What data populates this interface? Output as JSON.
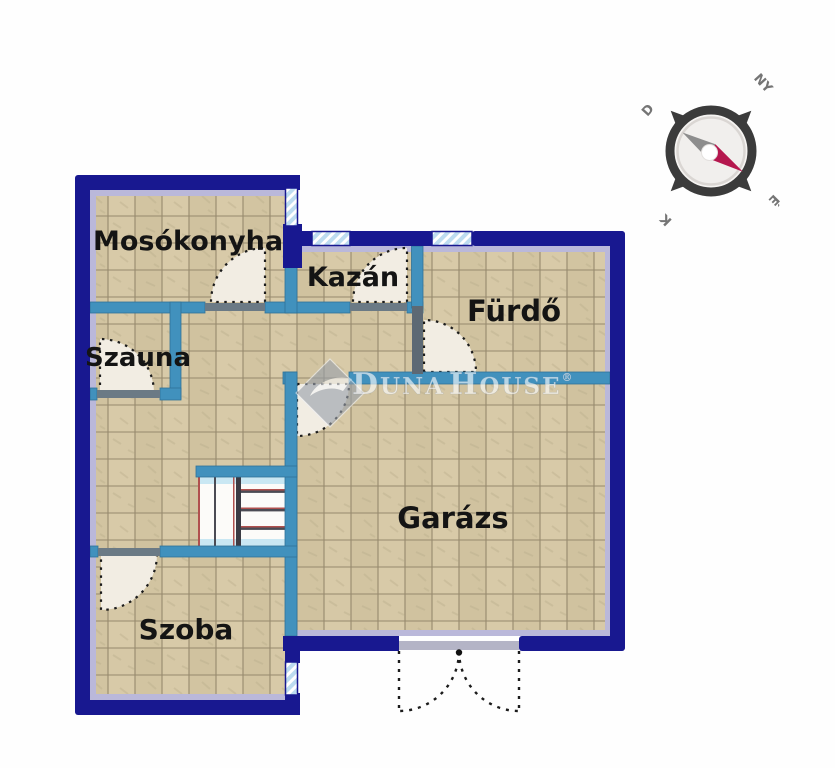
{
  "plan": {
    "rooms": [
      {
        "id": "mosokonyha",
        "label": "Mosókonyha"
      },
      {
        "id": "kazan",
        "label": "Kazán"
      },
      {
        "id": "furdo",
        "label": "Fürdő"
      },
      {
        "id": "szauna",
        "label": "Szauna"
      },
      {
        "id": "garazs",
        "label": "Garázs"
      },
      {
        "id": "szoba",
        "label": "Szoba"
      }
    ]
  },
  "compass": {
    "north": "É",
    "south": "D",
    "east": "K",
    "west": "NY"
  },
  "watermark": {
    "part1": "D",
    "part2": "UNA",
    "part3": "H",
    "part4": "OUSE",
    "registered": "®"
  },
  "colors": {
    "outer_wall_navy": "#181890",
    "inner_wall_blue": "#4191bd",
    "inner_wall_slate": "#5d6974",
    "door_leaf_gray": "#6b7a85",
    "floor_beige": "#d5c7a5",
    "floor_grid": "#96896d",
    "lavender_edge": "#bab8da",
    "window_blue": "#bddcf0",
    "door_swing_fill": "#f2ede3",
    "stair_red": "#b0504e",
    "needle_red": "#b5174e",
    "compass_ring": "#3b3b3b"
  }
}
